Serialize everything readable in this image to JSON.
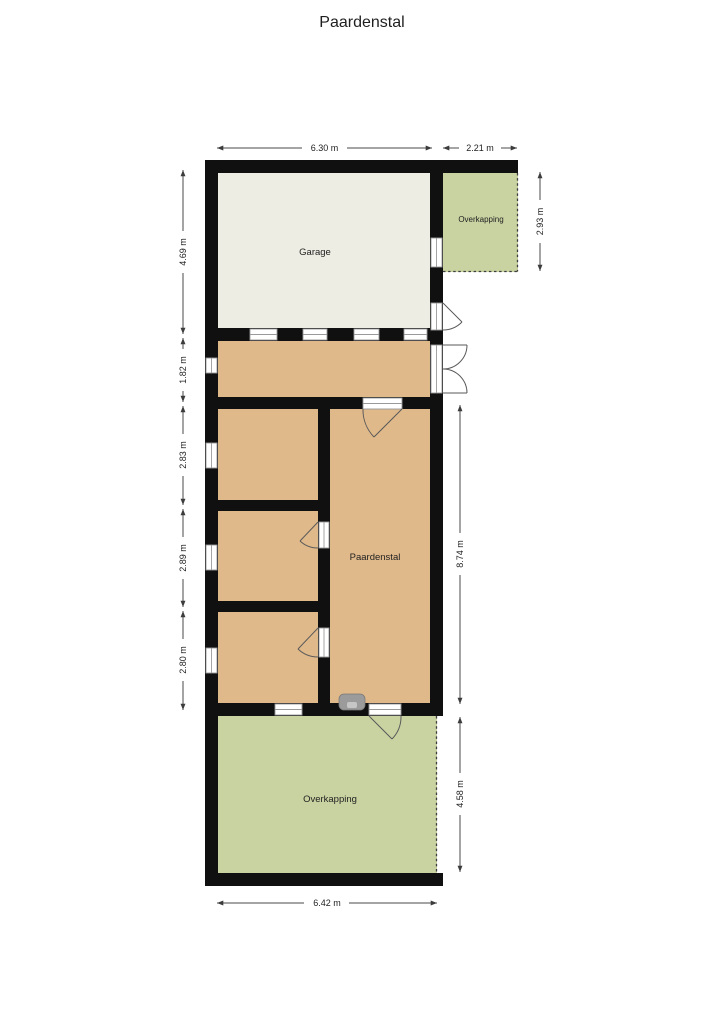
{
  "title": "Paardenstal",
  "rooms": {
    "garage": {
      "label": "Garage"
    },
    "overkapping_top": {
      "label": "Overkapping"
    },
    "paardenstal": {
      "label": "Paardenstal"
    },
    "overkapping_bottom": {
      "label": "Overkapping"
    }
  },
  "dimensions": {
    "top_width_main": "6.30 m",
    "top_width_overkapping": "2.21 m",
    "right_overkapping_top_height": "2.93 m",
    "left_garage_height": "4.69 m",
    "left_hall_height": "1.82 m",
    "left_room1_height": "2.83 m",
    "left_room2_height": "2.89 m",
    "left_room3_height": "2.80 m",
    "right_stable_height": "8.74 m",
    "right_overkapping_bottom_height": "4.58 m",
    "bottom_width": "6.42 m"
  },
  "icons": {
    "sink": "sink-fixture-top-view"
  },
  "colors": {
    "wall": "#101010",
    "garage_floor": "#eeede3",
    "room_floor": "#e0b98a",
    "overkapping_floor": "#c9d3a1",
    "dimension": "#4a4a4a"
  }
}
